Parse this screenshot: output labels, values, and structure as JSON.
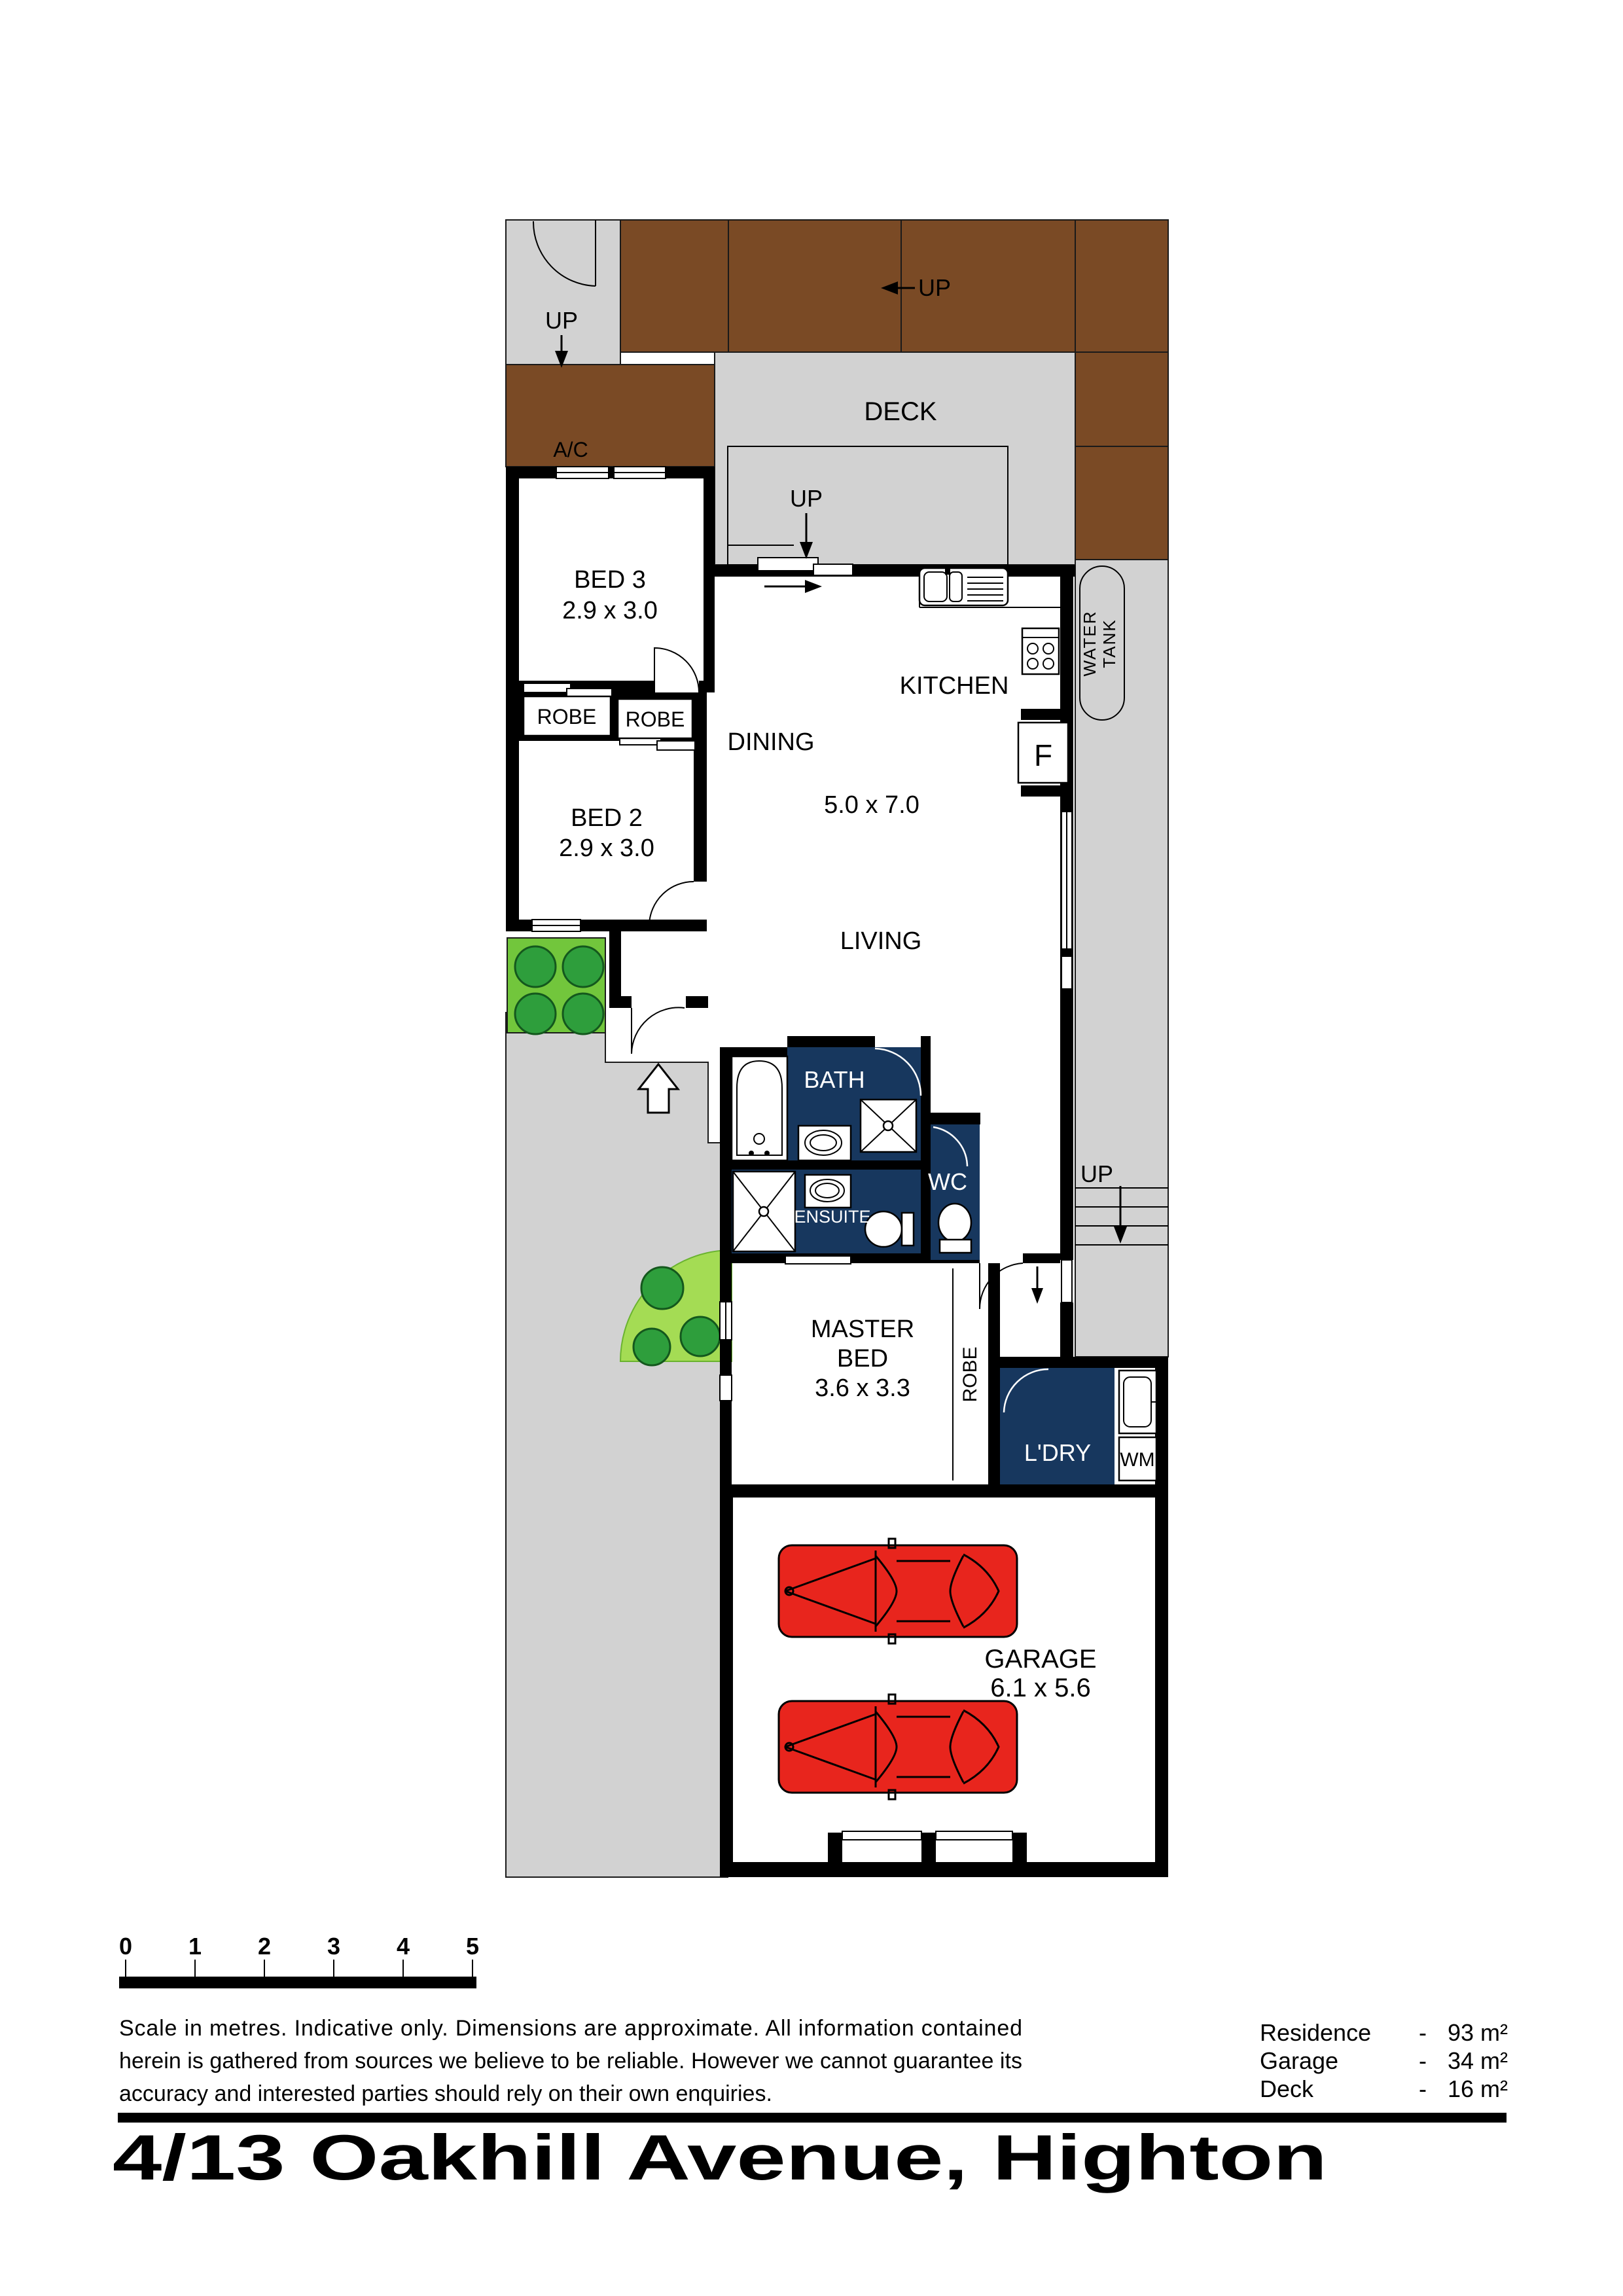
{
  "colors": {
    "navy": "#17375E",
    "brown": "#7A4A25",
    "path_gray": "#D2D2D2",
    "garden_green": "#72C63C",
    "garden_light": "#A4DC54",
    "shrub_green": "#2E9E3C",
    "car_red": "#E8251D"
  },
  "plan": {
    "labels": {
      "up": "UP",
      "deck": "DECK",
      "ac": "A/C",
      "water_tank_line1": "WATER",
      "water_tank_line2": "TANK",
      "bed3": "BED 3",
      "bed3_dims": "2.9 x 3.0",
      "bed2": "BED 2",
      "bed2_dims": "2.9 x 3.0",
      "robe": "ROBE",
      "dining": "DINING",
      "kitchen": "KITCHEN",
      "living": "LIVING",
      "living_dims": "5.0 x 7.0",
      "fridge": "F",
      "bath": "BATH",
      "ensuite": "ENSUITE",
      "wc": "WC",
      "master_line1": "MASTER",
      "master_line2": "BED",
      "master_dims": "3.6 x 3.3",
      "laundry": "L'DRY",
      "wm": "WM",
      "garage": "GARAGE",
      "garage_dims": "6.1 x 5.6"
    }
  },
  "scale_bar": {
    "ticks": [
      "0",
      "1",
      "2",
      "3",
      "4",
      "5"
    ]
  },
  "disclaimer": {
    "line1": "Scale in metres. Indicative only. Dimensions are approximate.  All information contained",
    "line2": "herein is gathered from sources we believe to be reliable. However we cannot guarantee its",
    "line3": "accuracy and interested parties should rely on their own enquiries."
  },
  "areas": {
    "separator": "-",
    "rows": [
      {
        "label": "Residence",
        "value": "93 m²"
      },
      {
        "label": "Garage",
        "value": "34 m²"
      },
      {
        "label": "Deck",
        "value": "16 m²"
      }
    ]
  },
  "title": "4/13 Oakhill Avenue, Highton"
}
